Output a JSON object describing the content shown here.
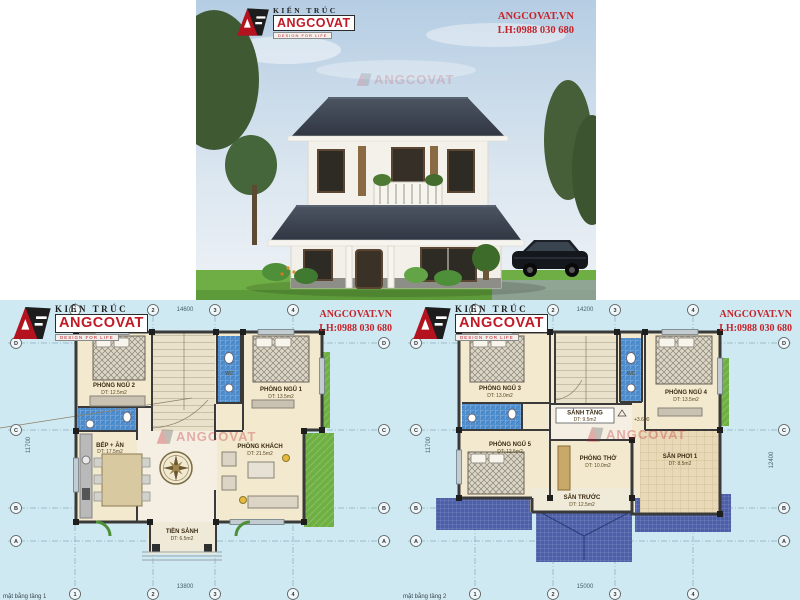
{
  "header": {
    "site": "ANGCOVAT.VN",
    "phone": "LH:0988 030 680"
  },
  "logo": {
    "kien_truc": "KIẾN TRÚC",
    "brand": "ANGCOVAT",
    "tagline": "DESIGN FOR LIFE"
  },
  "colors": {
    "brand_red": "#c01a26",
    "contact_red": "#c4232a",
    "plan_bg": "#cfe9f2",
    "roof_navy": "#4c5fa8",
    "bath_blue": "#4f8fd0",
    "lawn_green": "#6fb043",
    "floor_cream": "#f2e9cf",
    "wall_dark": "#3a3a3a"
  },
  "plan1": {
    "grid_cols": [
      "1",
      "2",
      "3",
      "4"
    ],
    "grid_rows": [
      "D",
      "C",
      "B",
      "A"
    ],
    "dims": {
      "top": "14600",
      "bottom": "13800",
      "left": "11700"
    },
    "caption": "mặt bằng tầng 1",
    "rooms": {
      "bed2": {
        "name": "PHÒNG NGỦ 2",
        "area": "DT: 12.5m2"
      },
      "bed1": {
        "name": "PHÒNG NGỦ 1",
        "area": "DT: 13.5m2"
      },
      "wc": {
        "name": "WC"
      },
      "kitchen": {
        "name": "BẾP + ĂN",
        "area": "DT: 17.5m2"
      },
      "living": {
        "name": "PHÒNG KHÁCH",
        "area": "DT: 21.5m2"
      },
      "porch": {
        "name": "TIỀN SẢNH",
        "area": "DT: 6.5m2"
      }
    }
  },
  "plan2": {
    "grid_cols": [
      "1",
      "2",
      "3",
      "4"
    ],
    "grid_rows": [
      "D",
      "C",
      "B",
      "A"
    ],
    "dims": {
      "top": "14200",
      "bottom": "15000",
      "left": "11700",
      "right": "12400"
    },
    "caption": "mặt bằng tầng 2",
    "level_mark": "+3.600",
    "rooms": {
      "bed3": {
        "name": "PHÒNG NGỦ 3",
        "area": "DT: 13.0m2"
      },
      "bed4": {
        "name": "PHÒNG NGỦ 4",
        "area": "DT: 13.5m2"
      },
      "bed5": {
        "name": "PHÒNG NGỦ 5",
        "area": "DT: 12.5m2"
      },
      "wc": {
        "name": "WC"
      },
      "hall": {
        "name": "SẢNH TẦNG",
        "area": "DT: 9.5m2"
      },
      "worship": {
        "name": "PHÒNG THỜ",
        "area": "DT: 10.0m2"
      },
      "balcony": {
        "name": "SÂN PHƠI 1",
        "area": "DT: 8.5m2"
      },
      "terrace": {
        "name": "SÂN TRƯỚC",
        "area": "DT: 12.5m2"
      }
    }
  }
}
